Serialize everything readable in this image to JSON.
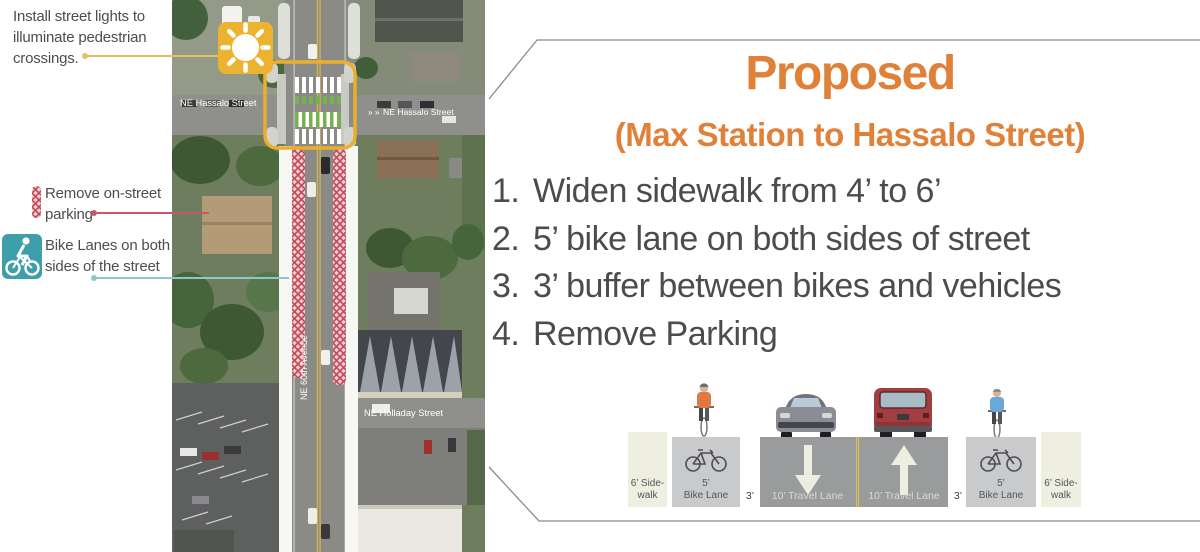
{
  "annotations": {
    "street_lights": "Install street lights to illuminate pedestrian crossings.",
    "remove_parking": "Remove on-street parking",
    "bike_lanes": "Bike Lanes on both sides of the street"
  },
  "map": {
    "labels": {
      "hassalo_left": "NE Hassalo Street",
      "hassalo_right_chevrons": "» »",
      "hassalo_right": "NE Hassalo Street",
      "avenue": "NE 60th Avenue",
      "holladay": "NE Holladay Street"
    }
  },
  "panel": {
    "title": "Proposed",
    "subtitle": "(Max Station to Hassalo Street)",
    "items": [
      {
        "num": "1.",
        "text": "Widen sidewalk from 4’ to 6’"
      },
      {
        "num": "2.",
        "text": "5’ bike lane on both sides of street"
      },
      {
        "num": "3.",
        "text": "3’ buffer between bikes and vehicles"
      },
      {
        "num": "4.",
        "text": "Remove Parking"
      }
    ]
  },
  "cross_section": {
    "segments": [
      {
        "type": "sidewalk",
        "line1": "6’ Side-",
        "line2": "walk"
      },
      {
        "type": "bike_lane",
        "line1": "5’",
        "line2": "Bike Lane"
      },
      {
        "type": "buffer",
        "label": "3’"
      },
      {
        "type": "travel_lane",
        "label": "10’ Travel Lane",
        "direction": "down"
      },
      {
        "type": "median"
      },
      {
        "type": "travel_lane",
        "label": "10’ Travel Lane",
        "direction": "up"
      },
      {
        "type": "buffer",
        "label": "3’"
      },
      {
        "type": "bike_lane",
        "line1": "5’",
        "line2": "Bike Lane"
      },
      {
        "type": "sidewalk",
        "line1": "6’ Side-",
        "line2": "walk"
      }
    ]
  },
  "colors": {
    "accent_orange": "#E0813A",
    "highlight_amber": "#EBB330",
    "hatch_red": "#BE4B59",
    "hatch_pink": "#F2CBD0",
    "teal_badge": "#3E9EA9",
    "text_dark": "#4B4C4E",
    "panel_border": "#8B8B8B"
  }
}
